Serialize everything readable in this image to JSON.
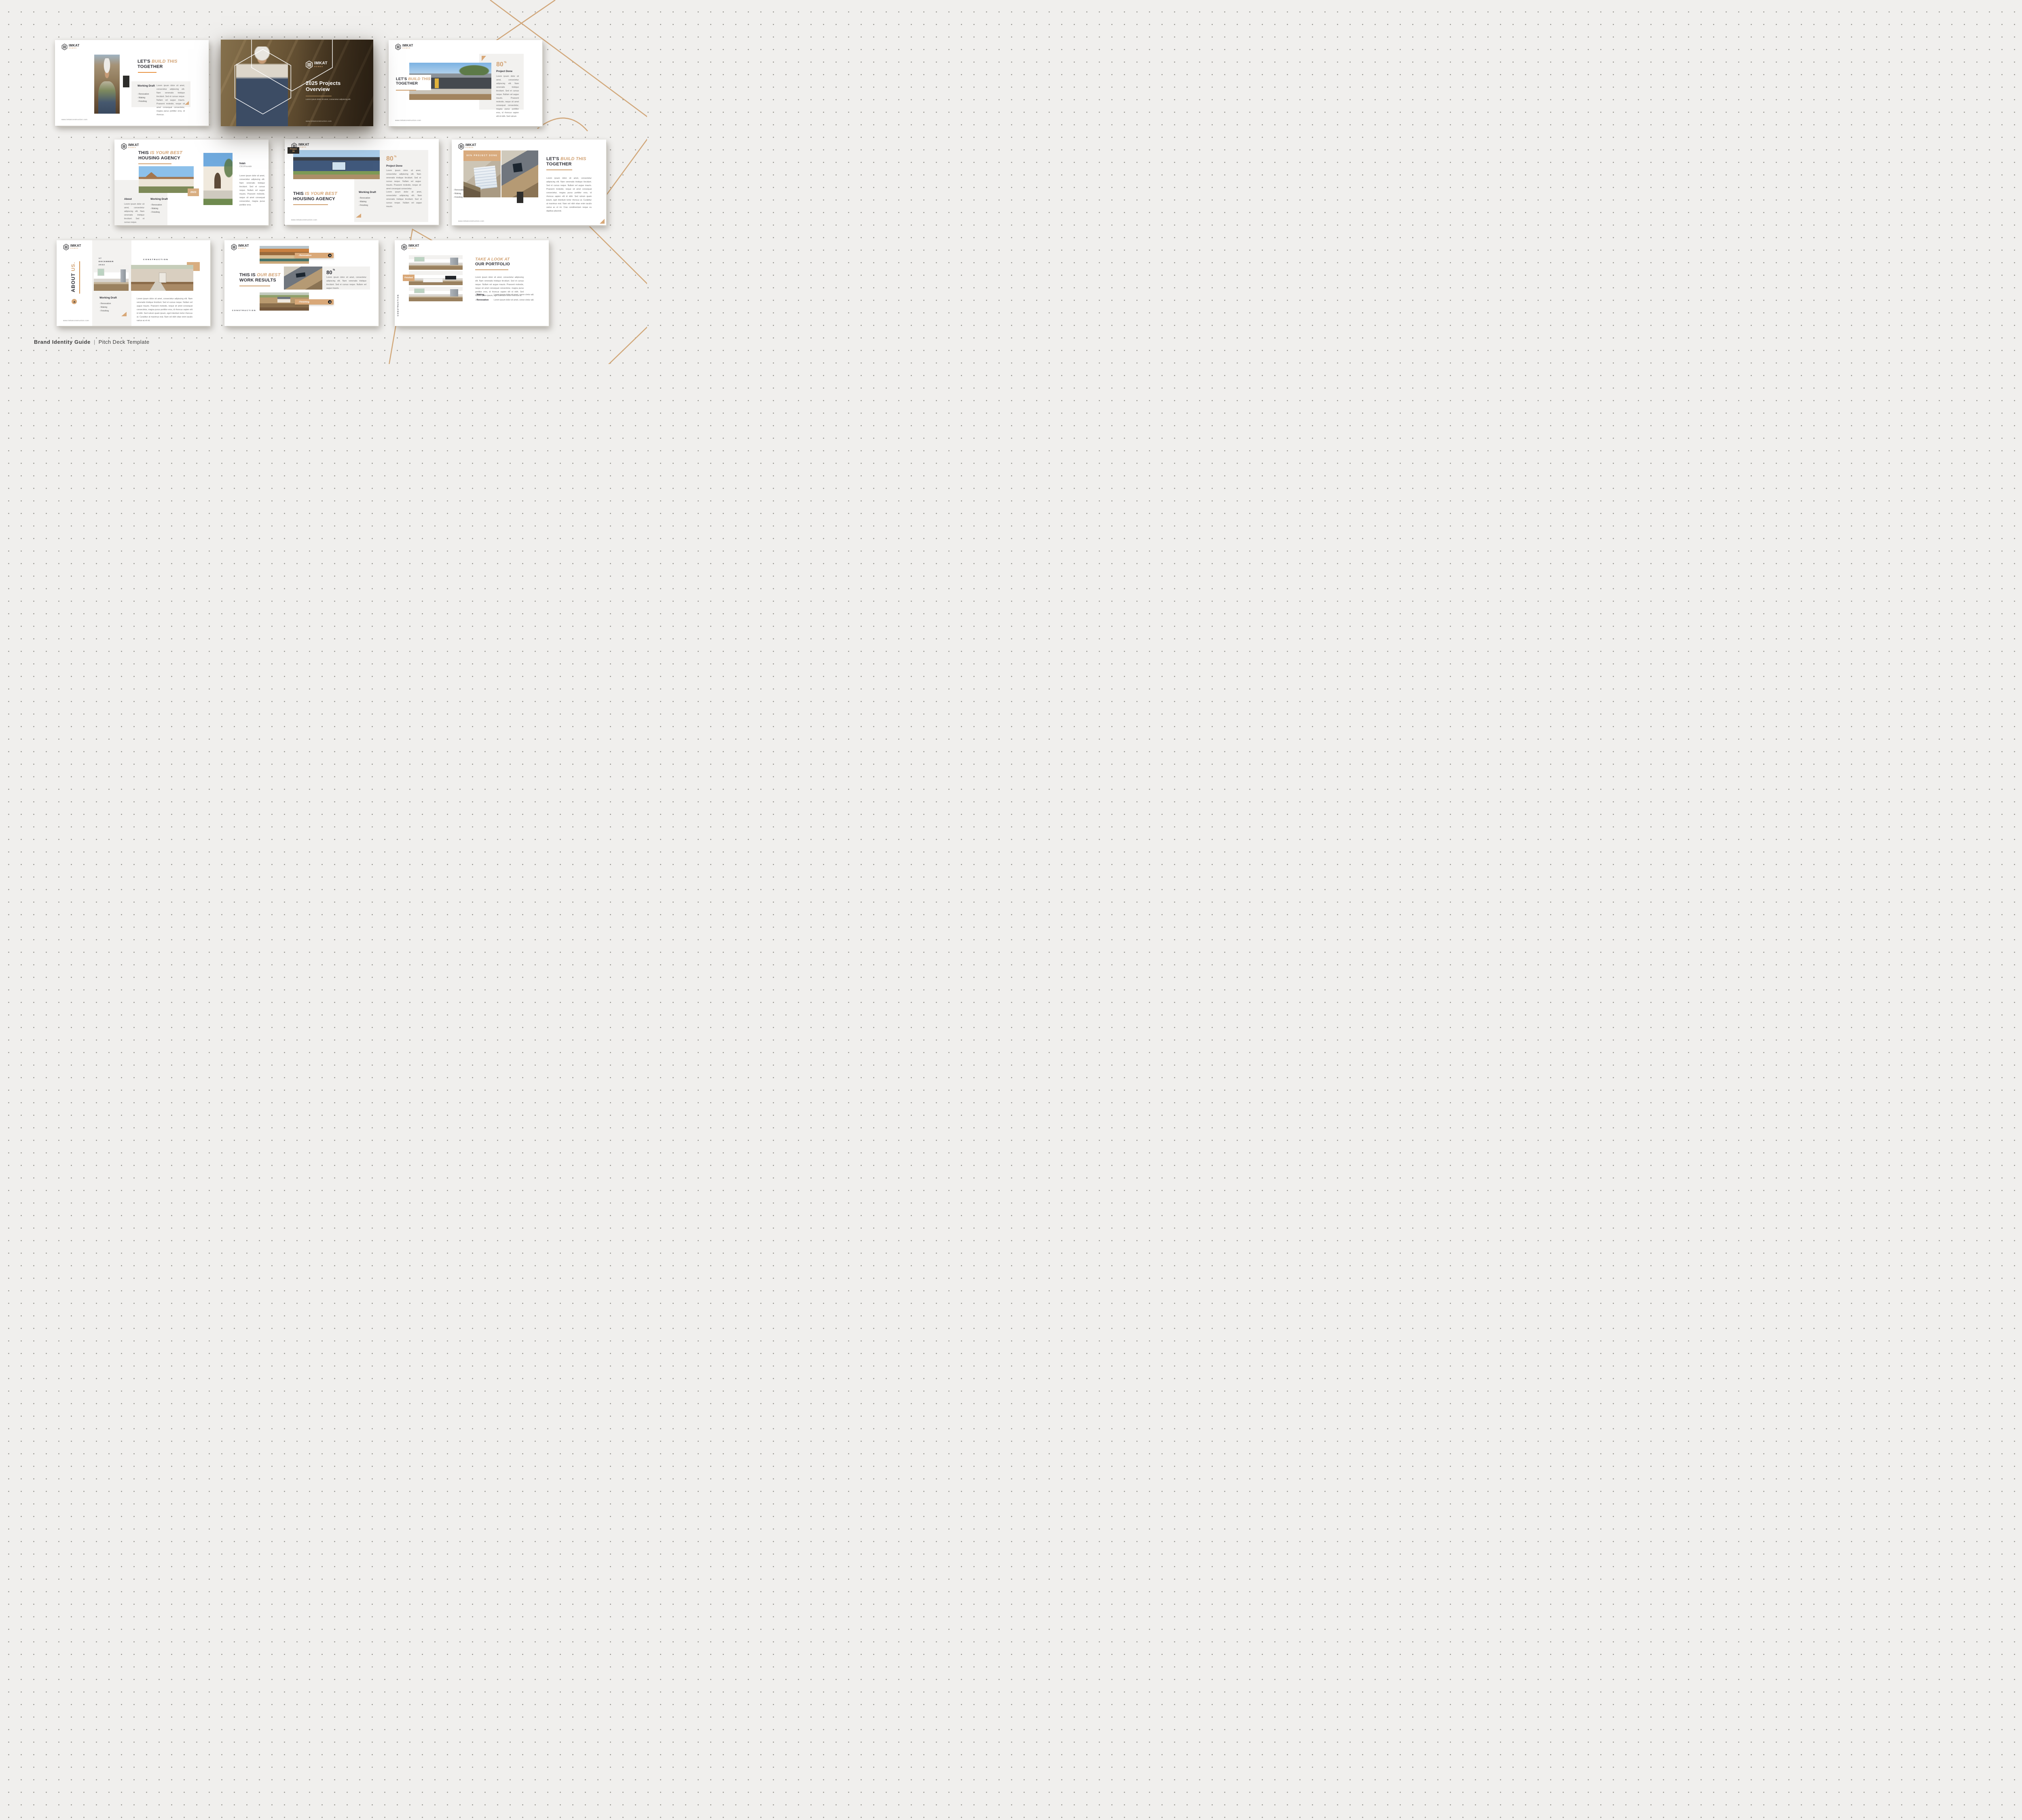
{
  "page": {
    "caption": {
      "left": "Brand Identity Guide",
      "separator": "|",
      "right": "Pitch Deck Template"
    }
  },
  "brand": {
    "name": "IMKAT",
    "tagline": "HOMES",
    "website": "www.imkatconstruction.com"
  },
  "colors": {
    "accent": "#d2a273",
    "orange": "#e8913f",
    "dark": "#2b2b32",
    "charcoal": "#2e2d2b",
    "panel": "#f2f1ef"
  },
  "common": {
    "working_draft": "Working Draft",
    "items": [
      "- Renovation",
      "- Making",
      "- Finishing"
    ],
    "construction": "CONSTRUCTION"
  },
  "slides": {
    "s1": {
      "title_a": "LET'S",
      "title_b": "BUILD THIS",
      "title_c": "TOGETHER",
      "body": "Lorem ipsum dolor sit amet, consectetur adipiscing elit. Nam venenatis tristique tincidunt. Sed et cursus neque. Nullam vel augue mauris. Praesent molestie, neque sit amet consequat consectetur, magna purus porttitor eros, id rhoncus."
    },
    "s2": {
      "title_line1": "2025 Projects",
      "title_line2": "Overview",
      "subtitle": "Lorem ipsum dolor sit amet, consectetur adipiscing elit."
    },
    "s3": {
      "stat_value": "80",
      "stat_unit": "%",
      "stat_label": "Project Done",
      "body": "Lorem ipsum dolor sit amet, consectetur adipiscing elit. Nam venenatis tristique tincidunt. Sed et cursus neque. Nullam vel augue mauris. Praesent molestie, neque sit amet consequat consectetur, magna purus porttitor eros, id rhoncus sapien elit id nibh. Sed rutrum",
      "title_a": "LET'S",
      "title_b": "BUILD THIS",
      "title_c": "TOGETHER"
    },
    "s4": {
      "title_a": "THIS",
      "title_b": "IS YOUR BEST",
      "title_c": "HOUSING AGENCY",
      "about_heading": "About",
      "about_body": "Lorem ipsum dolor sit amet, consectetur adipiscing elit. Nam venenatis tristique tincidunt. Sed et cursus neque.",
      "year_badge": "2023",
      "person_name": "Ivan",
      "person_role": "CEO/Founder",
      "person_body": "Lorem ipsum dolor sit amet, consectetur adipiscing elit. Nam venenatis tristique tincidunt. Sed et cursus neque. Nullam vel augue mauris. Praesent molestie, neque sit amet consequat consectetur, magna purus porttitor eros."
    },
    "s5": {
      "badge_line1": "Project",
      "badge_line2": "34",
      "stat_value": "80",
      "stat_unit": "%",
      "stat_label": "Project Done",
      "stat_body": "Lorem ipsum dolor sit amet, consectetur adipiscing elit. Nam venenatis tristique tincidunt. Sed et cursus neque. Nullam vel augue mauris. Praesent molestie, neque sit amet consequat consectetur.",
      "title_a": "THIS",
      "title_b": "IS YOUR BEST",
      "title_c": "HOUSING AGENCY",
      "draft_body": "Lorem ipsum dolor sit amet, consectetur adipiscing elit. Nam venenatis tristique tincidunt. Sed et cursus neque. Nullam vel augue mauris."
    },
    "s6": {
      "band": "80% PROJECT DONE",
      "title_a": "LET'S",
      "title_b": "BUILD THIS",
      "title_c": "TOGETHER",
      "body": "Lorem ipsum dolor sit amet, consectetur adipiscing elit. Nam venenatis tristique tincidunt. Sed et cursus neque. Nullam vel augue mauris. Praesent molestie, neque sit amet consequat consectetur, magna purus porttitor eros, id rhoncus sapien elit id nibh. Sed rutrum quam ipsum, eget interdum tortor rhoncus at. Curabitur at maximus erat. Nam vel nibh vitae enim iaculis varius ac et mi. Cras condimentum neque eu dapibus placerat."
    },
    "s7": {
      "vertical_a": "ABOUT",
      "vertical_b": "US.",
      "date_line1": "17",
      "date_line2": "DECEMBER",
      "date_line3": "2022",
      "section": "CONSTRUCTION",
      "body": "Lorem ipsum dolor sit amet, consectetur adipiscing elit. Nam venenatis tristique tincidunt. Sed et cursus neque. Nullam vel augue mauris. Praesent molestie, neque sit amet consequat consectetur, magna purus porttitor eros, id rhoncus sapien elit id nibh. Sed rutrum quam ipsum, eget interdum tortor rhoncus at. Curabitur at maximus erat. Nam vel nibh vitae enim iaculis varius ac et mi."
    },
    "s8": {
      "title_a": "THIS IS",
      "title_b": "OUR BEST",
      "title_c": "WORK RESULTS",
      "tag1": "- Renovation",
      "tag2": "- Finishing",
      "stat_value": "80",
      "stat_unit": "%",
      "stat_body": "Lorem ipsum dolor sit amet, consectetur adipiscing elit. Nam venenatis tristique tincidunt. Sed et cursus neque. Nullam vel augue mauris.",
      "section": "CONSTRUCTION"
    },
    "s9": {
      "title_a": "TAKE A LOOK AT",
      "title_b": "OUR PORTFOLIO",
      "badge": "Finished",
      "body": "Lorem ipsum dolor sit amet, consectetur adipiscing elit. Nam venenatis tristique tincidunt. Sed et cursus neque. Nullam vel augue mauris. Praesent molestie, neque sit amet consequat consectetur, magna purus porttitor eros, id rhoncus sapien elit id nibh. Sed rutrum quam ipsum, eget interdum tortor rhoncus at.",
      "row1_label": "- Making",
      "row1_text": "Lorem ipsum dolor sit amet, conse ctetur adi.",
      "row2_label": "- Renovation",
      "row2_text": "Lorem ipsum dolor sit amet, conse ctetur adi.",
      "section": "CONSTRUCTION"
    }
  }
}
